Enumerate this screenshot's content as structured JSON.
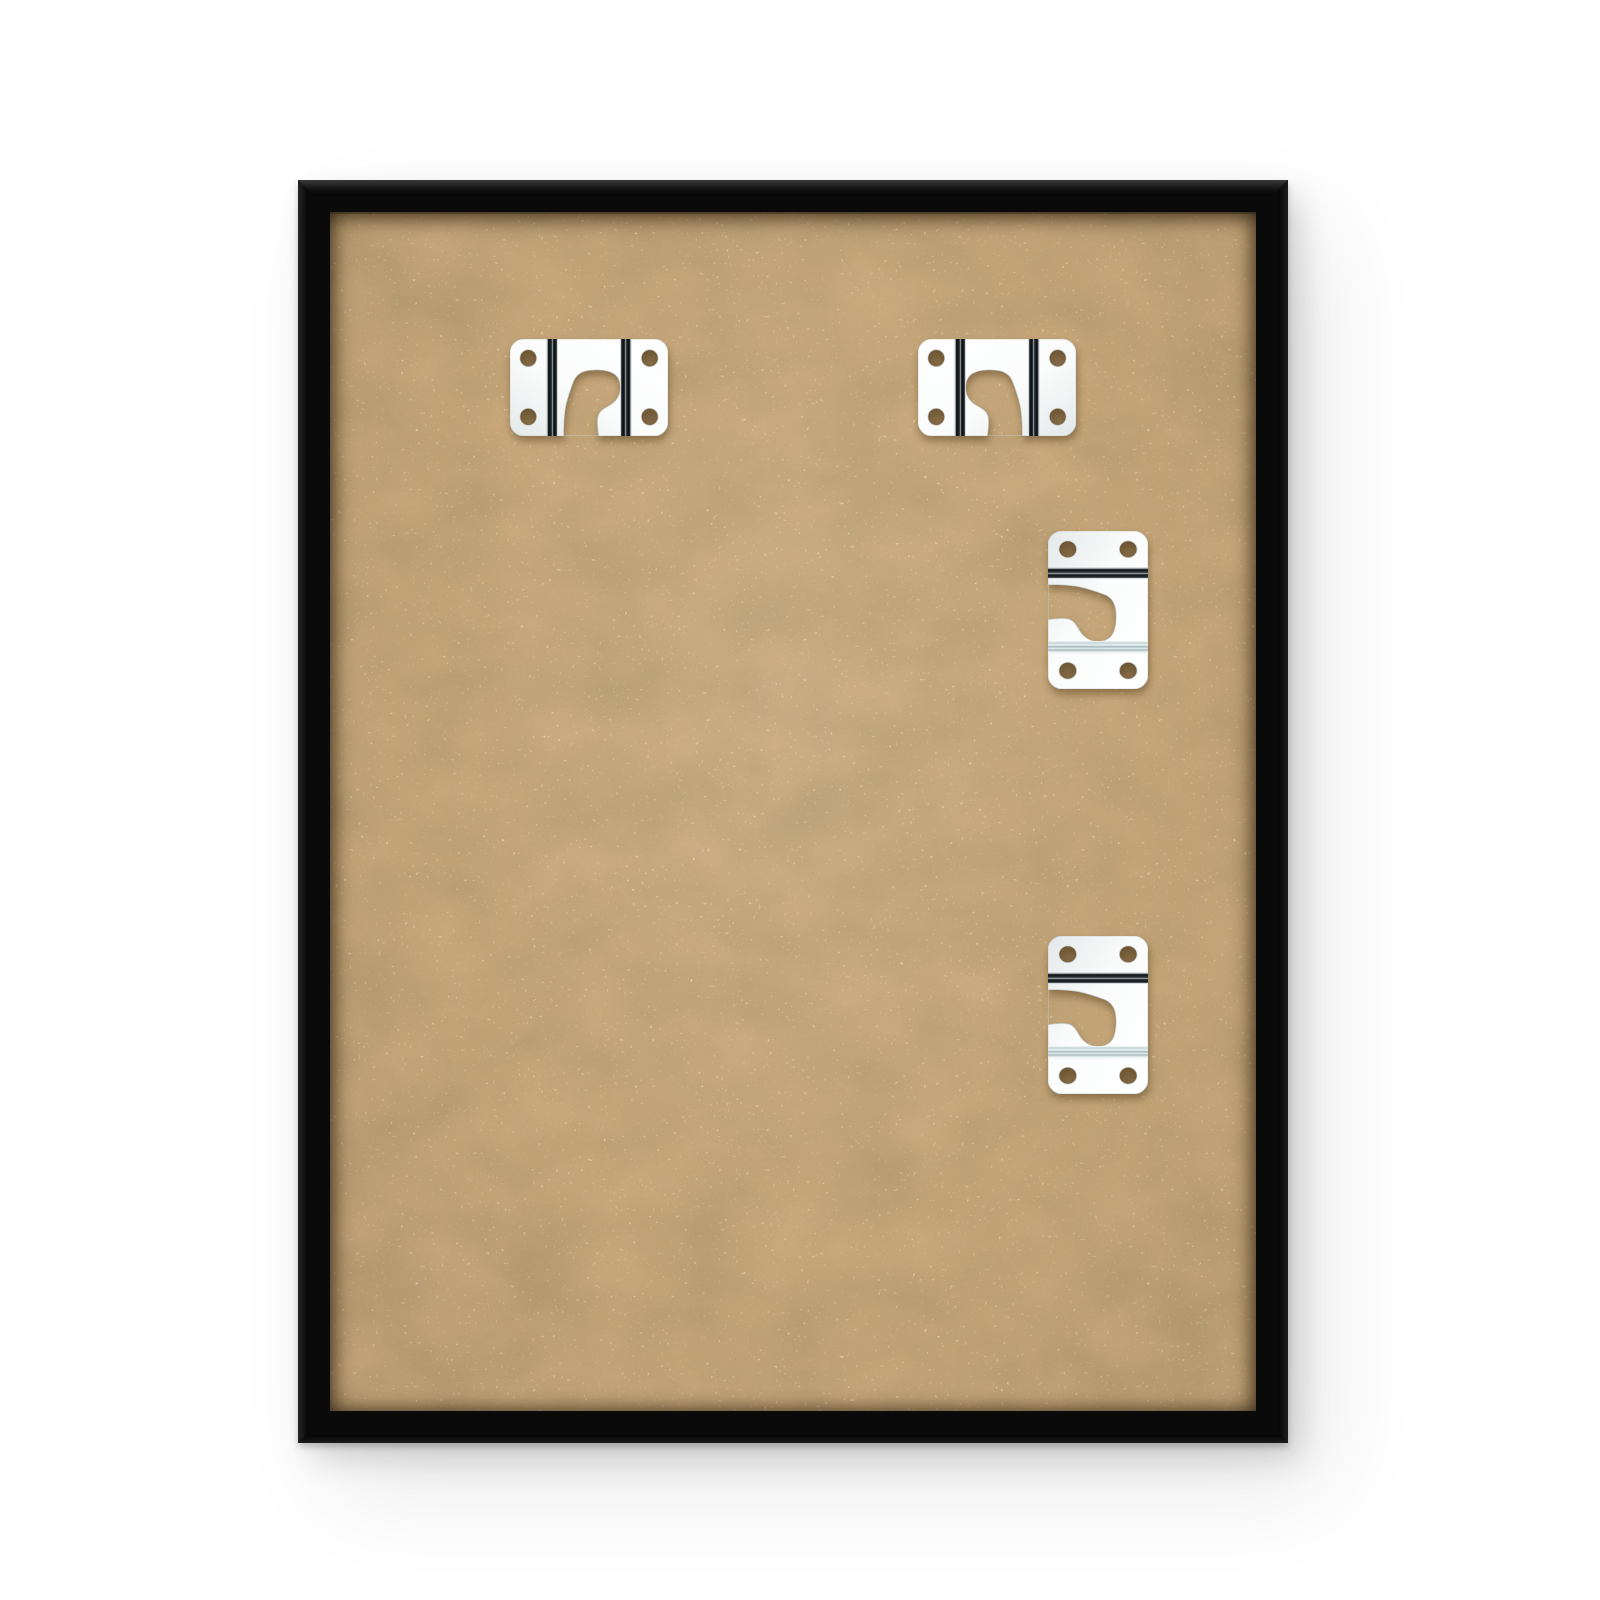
{
  "scene": {
    "type": "product-photo",
    "description": "Back view of a black picture frame with a kraft MDF backing board and four chrome wall-hanger brackets",
    "background_color": "#ffffff"
  },
  "frame": {
    "label": "black picture frame, back side",
    "color": "#0a0a0b",
    "border_thickness_px": 32
  },
  "board": {
    "label": "kraft MDF backing board",
    "color": "#c8a77a",
    "speckle_color": "#efe3c4",
    "mottle_color": "#59451f"
  },
  "bracket_style": {
    "label": "chrome sawtooth-style hanger plate with keyhole hook cutout and four screw holes",
    "plate_color": "#ffffff",
    "bend_dark_color": "#0c0f12",
    "bend_light_color": "#a9bcc0"
  },
  "brackets": [
    {
      "id": "hanger-bracket-top-left",
      "variant": "horizontal-mirrored",
      "x": 510,
      "y": 339,
      "width": 158,
      "height": 97
    },
    {
      "id": "hanger-bracket-top-right",
      "variant": "horizontal",
      "x": 918,
      "y": 339,
      "width": 158,
      "height": 97
    },
    {
      "id": "hanger-bracket-middle-right",
      "variant": "vertical",
      "x": 1048,
      "y": 531,
      "width": 100,
      "height": 158
    },
    {
      "id": "hanger-bracket-bottom-right",
      "variant": "vertical",
      "x": 1048,
      "y": 936,
      "width": 100,
      "height": 158
    }
  ]
}
